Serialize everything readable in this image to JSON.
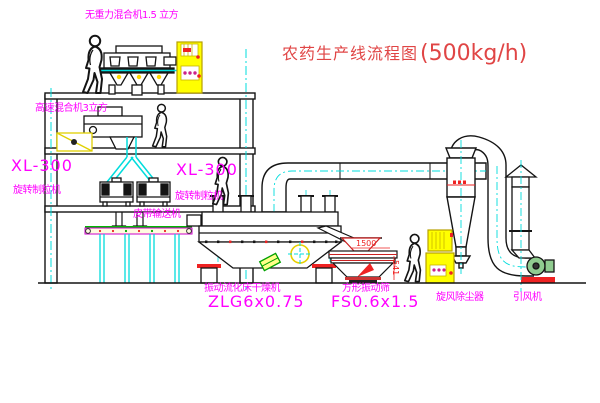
{
  "title": {
    "text": "农药生产线流程图",
    "capacity": "(500kg/h)"
  },
  "equipment_labels": {
    "gravity_mixer": "无重力混合机1.5 立方",
    "high_speed_mixer": "高速混合机3立方",
    "granulator_left_model": "XL-300",
    "granulator_left_name": "旋转制粒机",
    "granulator_right_model": "XL-300",
    "granulator_right_name": "旋转制粒机",
    "belt_conveyor": "皮带输送机",
    "dryer_name": "振动流化床干燥机",
    "dryer_model": "ZLG6x0.75",
    "sieve_name": "方形振动筛",
    "sieve_model": "FS0.6x1.5",
    "cyclone": "旋风除尘器",
    "fan": "引风机"
  },
  "dimensions": {
    "sieve_width": "1500",
    "sieve_height": "541"
  },
  "colors": {
    "label_magenta": "#ff00ff",
    "title_red": "#e04545",
    "line_black": "#141414",
    "cad_cyan": "#00dcdc",
    "cad_yellow": "#ffff00",
    "cad_green": "#00b400",
    "cad_red": "#ee2222"
  }
}
